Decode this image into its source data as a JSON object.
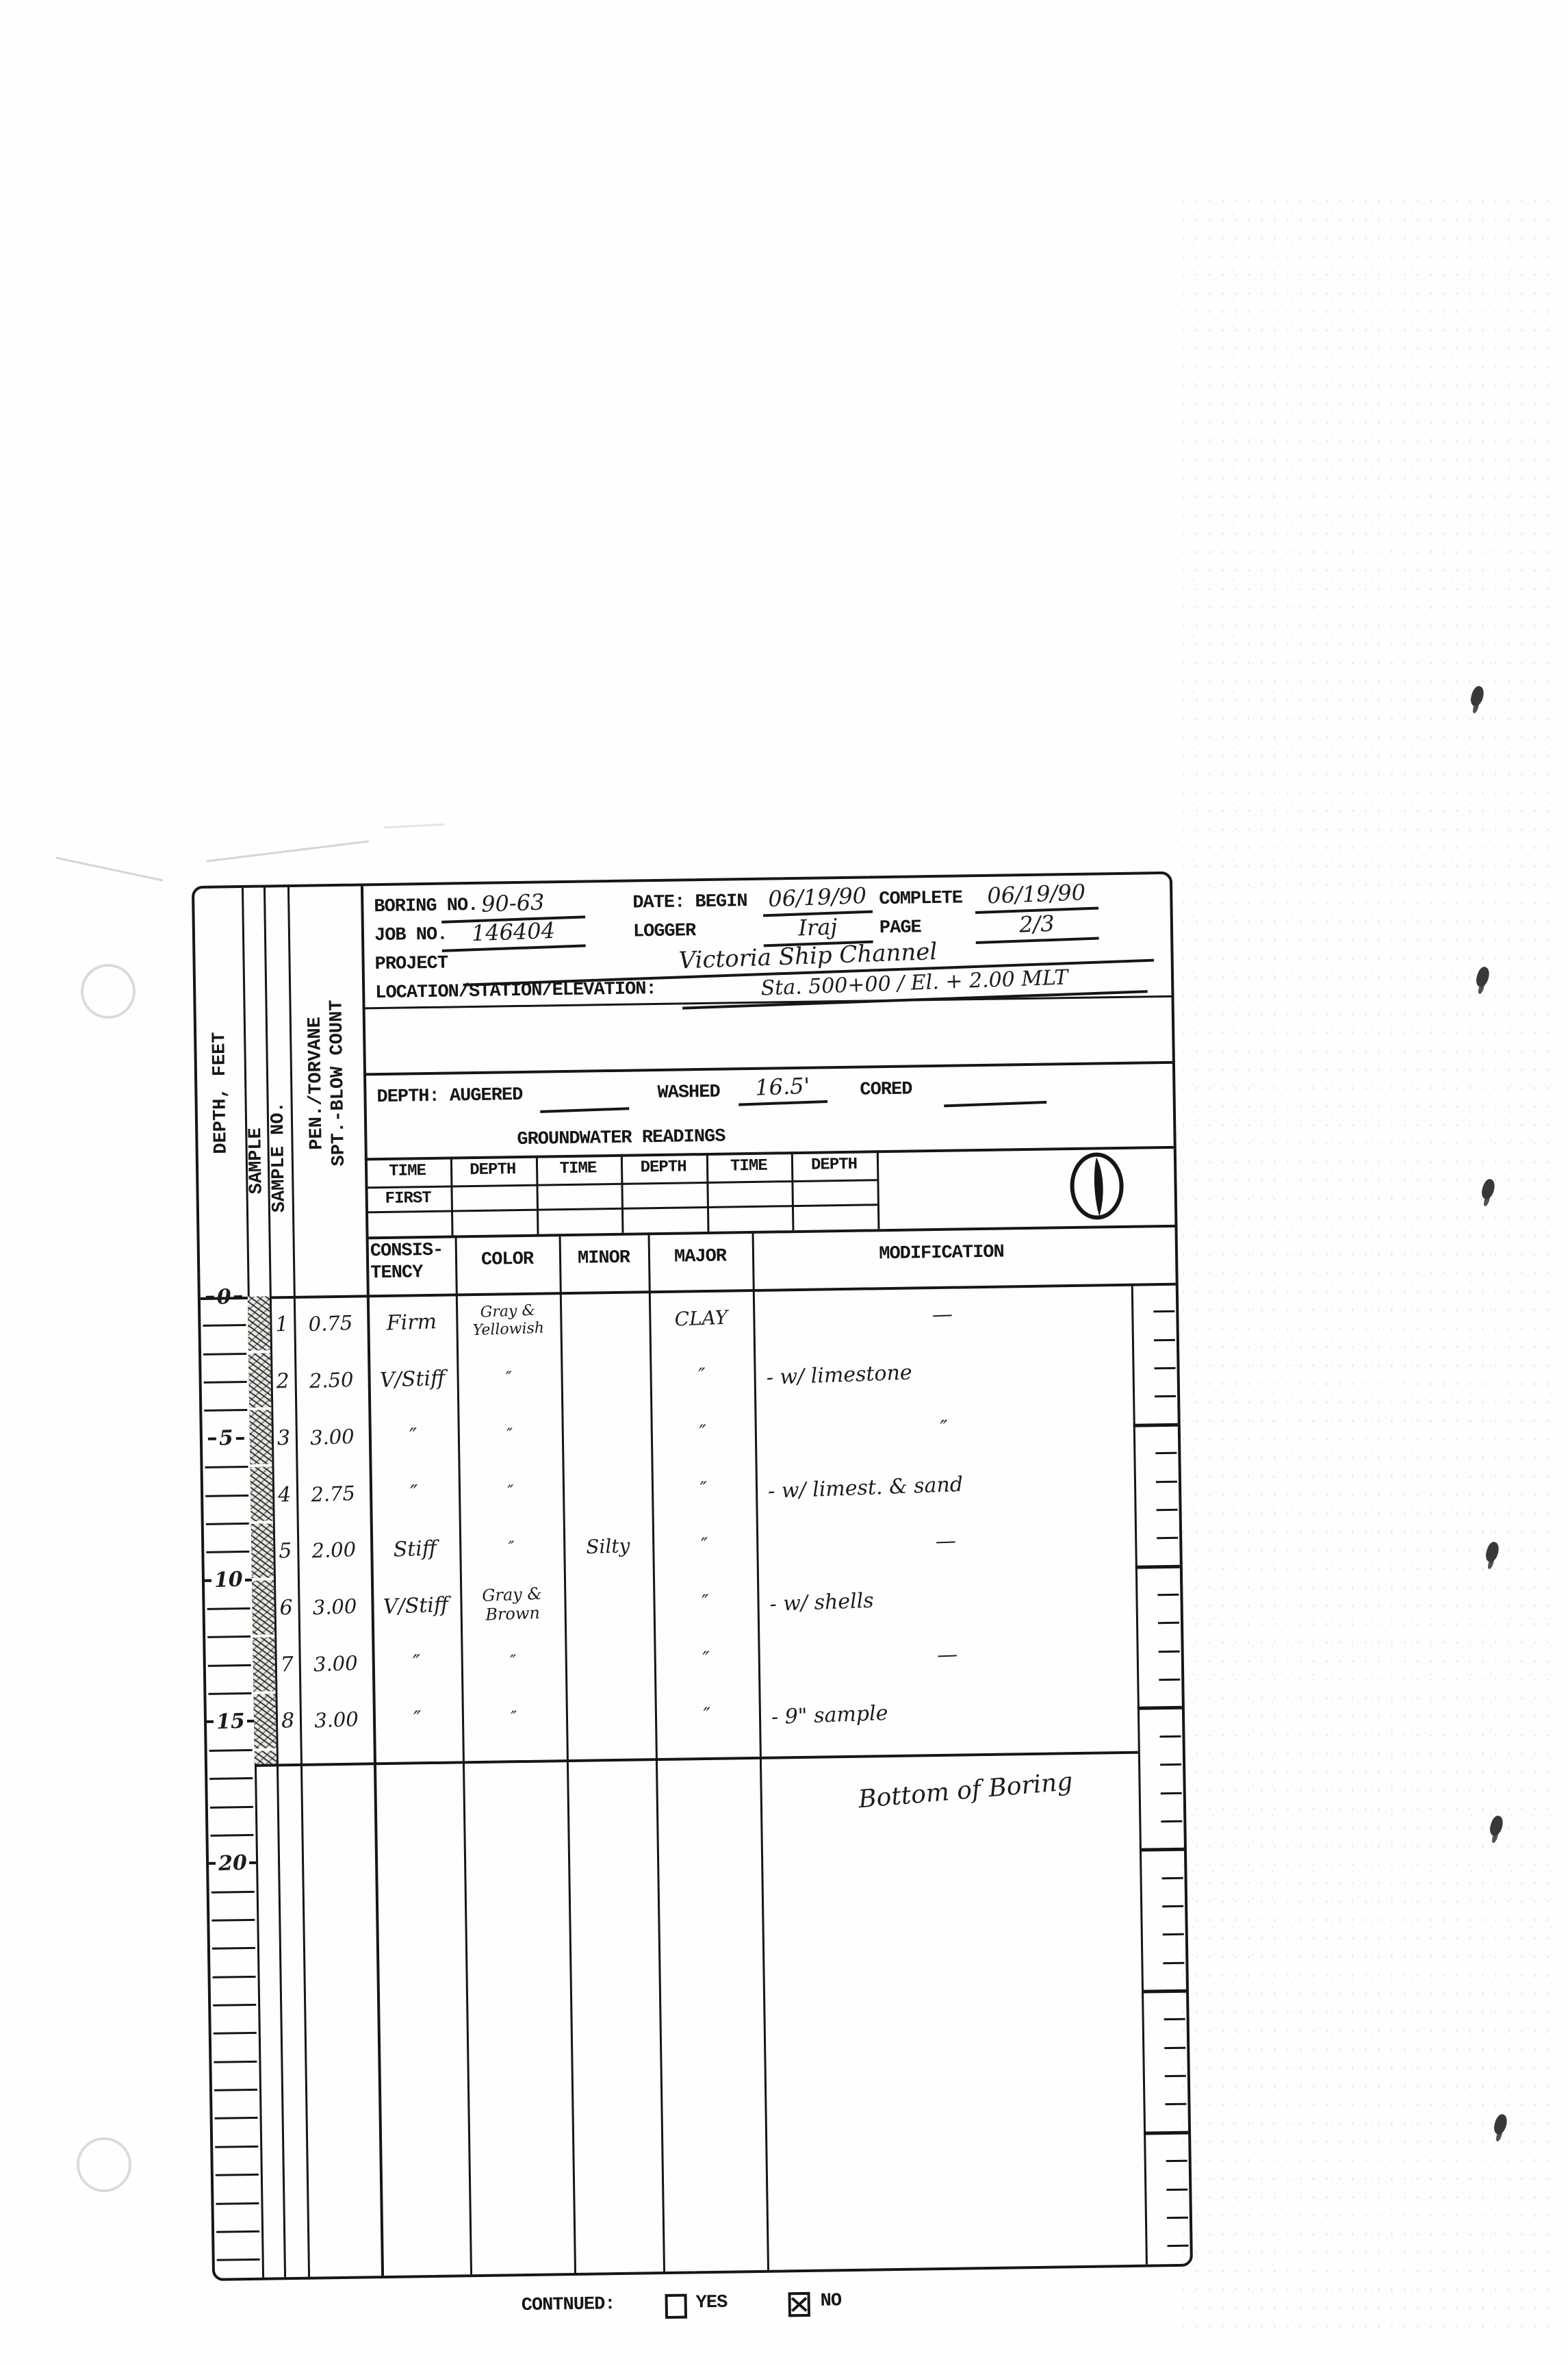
{
  "ink_color": "#161616",
  "paper_color": "#fffefd",
  "header": {
    "boring_label": "BORING NO.",
    "boring_value": "90-63",
    "date_label": "DATE: BEGIN",
    "date_begin": "06/19/90",
    "complete_label": "COMPLETE",
    "date_complete": "06/19/90",
    "job_label": "JOB NO.",
    "job_value": "146404",
    "logger_label": "LOGGER",
    "logger_value": "Iraj",
    "page_label": "PAGE",
    "page_value": "2/3",
    "project_label": "PROJECT",
    "project_value": "Victoria Ship Channel",
    "location_label": "LOCATION/STATION/ELEVATION:",
    "location_value": "Sta. 500+00 / El. + 2.00 MLT"
  },
  "depth_section": {
    "label": "DEPTH: AUGERED",
    "augered_value": "",
    "washed_label": "WASHED",
    "washed_value": "16.5'",
    "cored_label": "CORED",
    "cored_value": ""
  },
  "groundwater": {
    "title": "GROUNDWATER READINGS",
    "headers": [
      "TIME",
      "DEPTH",
      "TIME",
      "DEPTH",
      "TIME",
      "DEPTH"
    ],
    "first_label": "FIRST",
    "symbol": "clock-pie-icon"
  },
  "column_headers": {
    "depth_feet": "DEPTH, FEET",
    "sample": "SAMPLE",
    "sample_no": "SAMPLE NO.",
    "pen_torvane": "PEN./TORVANE",
    "spt_blow": "SPT.-BLOW COUNT",
    "consistency": "CONSIS-\nTENCY",
    "color": "COLOR",
    "minor": "MINOR",
    "major": "MAJOR",
    "modification": "MODIFICATION"
  },
  "depth_scale": {
    "labeled": [
      0,
      5,
      10,
      15,
      20
    ],
    "feet_per_tick": 1,
    "max_tick": 34,
    "bottom_of_boring_depth_ft": 16.5
  },
  "samples": [
    {
      "no": "1",
      "pen": "0.75",
      "consistency": "Firm",
      "color": "Gray &\nYellowish",
      "minor": "",
      "major": "CLAY",
      "modification": "—"
    },
    {
      "no": "2",
      "pen": "2.50",
      "consistency": "V/Stiff",
      "color": "″",
      "minor": "",
      "major": "″",
      "modification": "- w/ limestone"
    },
    {
      "no": "3",
      "pen": "3.00",
      "consistency": "″",
      "color": "″",
      "minor": "",
      "major": "″",
      "modification": "″"
    },
    {
      "no": "4",
      "pen": "2.75",
      "consistency": "″",
      "color": "″",
      "minor": "",
      "major": "″",
      "modification": "- w/ limest. & sand"
    },
    {
      "no": "5",
      "pen": "2.00",
      "consistency": "Stiff",
      "color": "″",
      "minor": "Silty",
      "major": "″",
      "modification": "—"
    },
    {
      "no": "6",
      "pen": "3.00",
      "consistency": "V/Stiff",
      "color": "Gray & Brown",
      "minor": "",
      "major": "″",
      "modification": "- w/ shells"
    },
    {
      "no": "7",
      "pen": "3.00",
      "consistency": "″",
      "color": "″",
      "minor": "",
      "major": "″",
      "modification": "—"
    },
    {
      "no": "8",
      "pen": "3.00",
      "consistency": "″",
      "color": "″",
      "minor": "",
      "major": "″",
      "modification": "- 9\" sample"
    }
  ],
  "annotations": {
    "bottom_of_boring": "Bottom of Boring"
  },
  "footer": {
    "continued_label": "CONTNUED:",
    "yes_label": "YES",
    "no_label": "NO",
    "checked": "NO"
  }
}
